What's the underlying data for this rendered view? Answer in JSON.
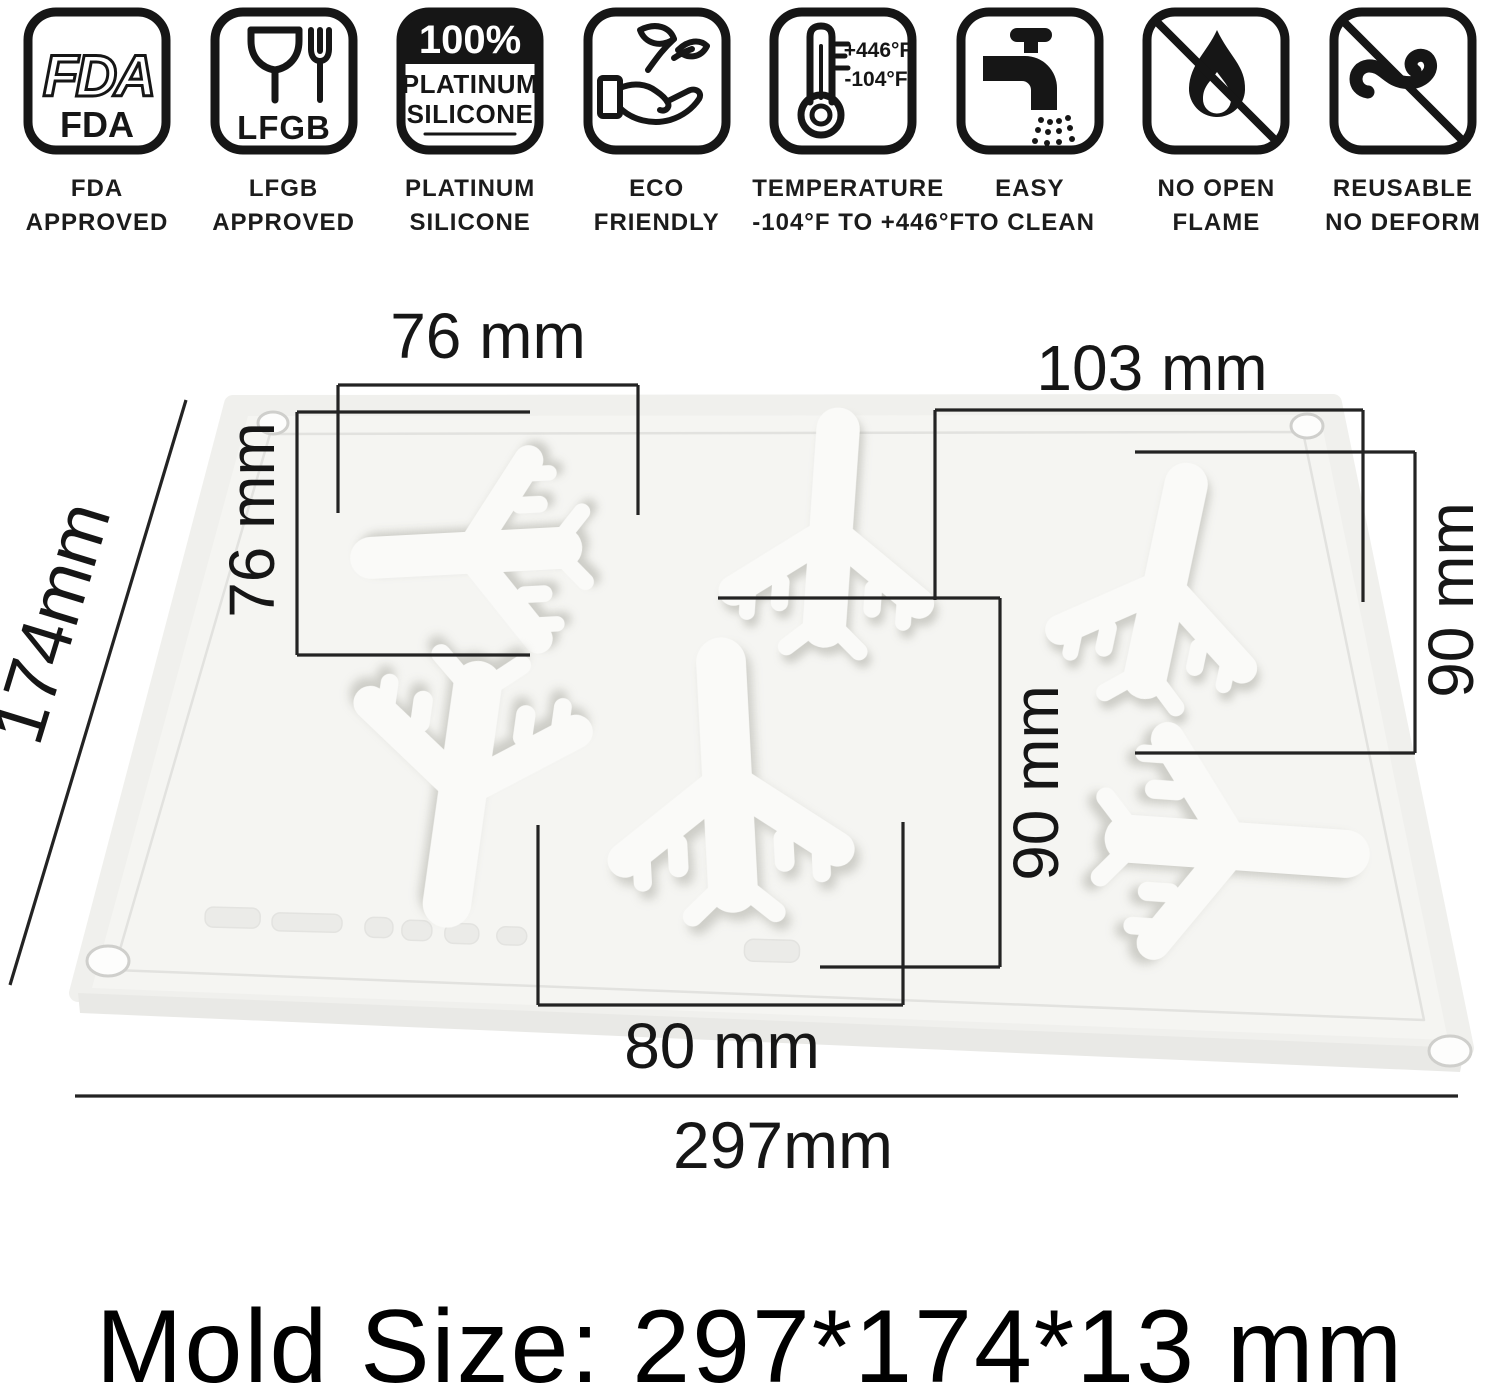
{
  "badges": [
    {
      "icon": "fda-approved-icon",
      "icon_text_outline": "FDA",
      "icon_text_solid": "FDA",
      "label_line1": "FDA",
      "label_line2": "APPROVED"
    },
    {
      "icon": "lfgb-glass-fork-icon",
      "icon_text": "LFGB",
      "label_line1": "LFGB",
      "label_line2": "APPROVED"
    },
    {
      "icon": "platinum-silicone-badge-icon",
      "icon_text_percent": "100%",
      "icon_text_line1": "PLATINUM",
      "icon_text_line2": "SILICONE",
      "label_line1": "PLATINUM",
      "label_line2": "SILICONE"
    },
    {
      "icon": "eco-hand-leaf-icon",
      "label_line1": "ECO",
      "label_line2": "FRIENDLY"
    },
    {
      "icon": "thermometer-icon",
      "icon_temp_high": "+446°F",
      "icon_temp_low": "-104°F",
      "label_line1": "TEMPERATURE",
      "label_line2": "-104°F TO +446°F"
    },
    {
      "icon": "faucet-clean-icon",
      "label_line1": "EASY",
      "label_line2": "TO CLEAN"
    },
    {
      "icon": "no-open-flame-icon",
      "label_line1": "NO OPEN",
      "label_line2": "FLAME"
    },
    {
      "icon": "reusable-no-deform-icon",
      "label_line1": "REUSABLE",
      "label_line2": "NO DEFORM"
    }
  ],
  "diagram": {
    "dim_top_left_width": "76 mm",
    "dim_left_cavity_height": "76 mm",
    "dim_top_right_width": "103 mm",
    "dim_right_cavity_height": "90 mm",
    "dim_middle_cavity_height": "90 mm",
    "dim_bottom_cavity_width": "80 mm",
    "dim_mold_height": "174mm",
    "dim_mold_width": "297mm"
  },
  "footer": {
    "mold_size_text": "Mold Size: 297*174*13 mm"
  },
  "colors": {
    "line": "#232323",
    "mold_fill": "#f0f0ed",
    "plane_fill": "#fafaf8",
    "icon_ink": "#161616"
  }
}
